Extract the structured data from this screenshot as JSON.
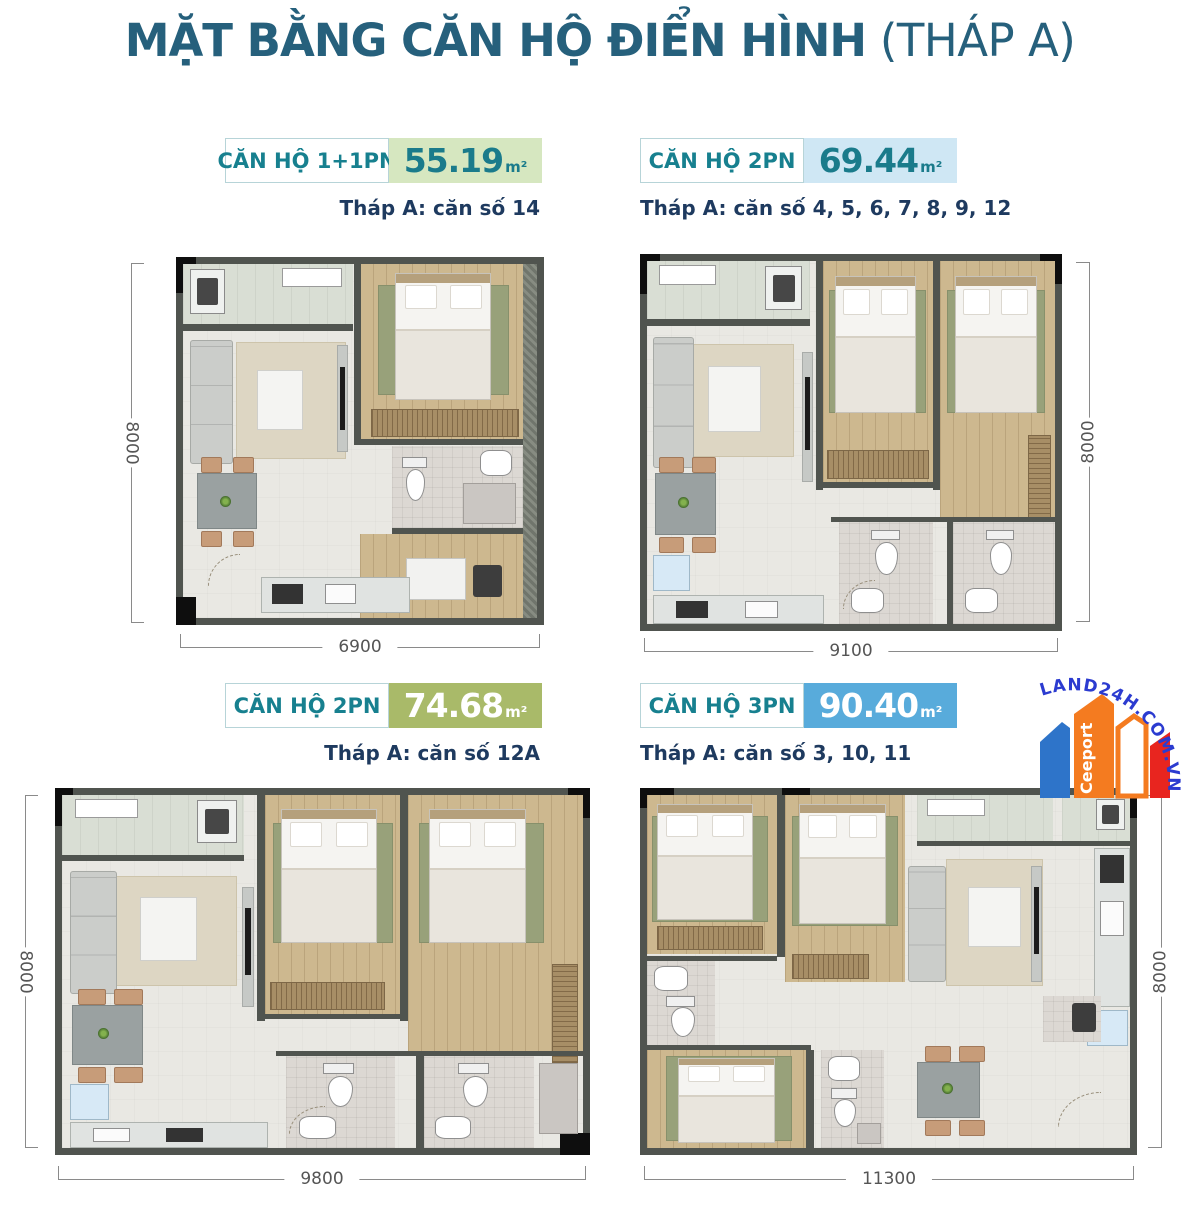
{
  "title": {
    "main": "MẶT BẰNG CĂN HỘ ĐIỂN HÌNH",
    "suffix": " (THÁP A)"
  },
  "watermark": {
    "arc_text": "LAND24H.COM.VN",
    "brand": "Ceeport"
  },
  "colors": {
    "title_text": "#26607c",
    "badge_label_text": "#17808f",
    "caption_text": "#1e3a5f",
    "area_bg_unit1": "#d6e7c0",
    "area_bg_unit2": "#cfe7f4",
    "area_bg_unit3": "#a9ba69",
    "area_bg_unit4": "#58abdb",
    "area_text_teal": "#1a7b8b",
    "area_text_white": "#ffffff",
    "dimension_text": "#555555",
    "wall_color": "#50544f",
    "logo_arc_text": "#2b3bd0",
    "logo_blue": "#2e74c9",
    "logo_orange": "#f47b20",
    "logo_red": "#e8251f"
  },
  "units": [
    {
      "type": "CĂN HỘ 1+1PN",
      "area": "55.19",
      "area_unit": "m²",
      "caption": "Tháp A: căn số 14",
      "height_dim": "8000",
      "width_dim": "6900"
    },
    {
      "type": "CĂN HỘ 2PN",
      "area": "69.44",
      "area_unit": "m²",
      "caption": "Tháp A: căn số 4, 5, 6, 7, 8, 9, 12",
      "height_dim": "8000",
      "width_dim": "9100"
    },
    {
      "type": "CĂN HỘ 2PN",
      "area": "74.68",
      "area_unit": "m²",
      "caption": "Tháp A: căn số 12A",
      "height_dim": "8000",
      "width_dim": "9800"
    },
    {
      "type": "CĂN HỘ 3PN",
      "area": "90.40",
      "area_unit": "m²",
      "caption": "Tháp A: căn số 3, 10, 11",
      "height_dim": "8000",
      "width_dim": "11300"
    }
  ]
}
